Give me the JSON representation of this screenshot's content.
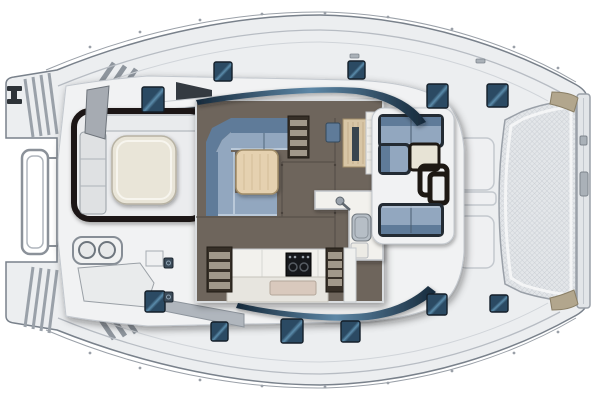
{
  "title": "Catamaran yacht deck and saloon floor plan, top view, bow to the right",
  "image_type": "boat-floor-plan-illustration",
  "orientation": {
    "bow": "right",
    "stern": "left"
  },
  "palette": {
    "bg": "#ffffff",
    "hull": "#eceef0",
    "hull_stroke": "#79818b",
    "deck": "#f1f2f3",
    "deck_line": "#c3c8ce",
    "inner_line": "#b7bcc3",
    "floor": "#6e655c",
    "floor_seam": "#58514a",
    "sofa_back": "#5f7b99",
    "sofa_seat": "#92a7bf",
    "sofa_hi": "#bac9d9",
    "sofa_frame": "#232b33",
    "table_wood": "#e5d1b0",
    "table_wood_edge": "#a08c67",
    "table_cream": "#e9e5d8",
    "table_cream_edge": "#b7b2a3",
    "counter": "#f2f1ed",
    "counter_front": "#e7e5df",
    "counter_edge": "#c0c4c9",
    "sink_tray": "#d9c9bd",
    "sink_steel": "#b6bec6",
    "cooktop": "#16181c",
    "steps_dark": "#362f27",
    "tread": "#a1988a",
    "nav_desk": "#d8c6a6",
    "nav_panel": "#39454e",
    "bench_grey": "#dfe1e3",
    "seat_grey": "#a6abb2",
    "frame_dark": "#1d1813",
    "hatch": "#2b4a63",
    "hatch_hi": "#5b8cab",
    "hatch_stroke": "#141f2a",
    "swoosh": "#16293a",
    "swoosh_hi": "#5d87a6",
    "mesh": "#e3e6e9",
    "mesh_line": "#c6cbd1",
    "beam": "#e2e5e8",
    "metal": "#9aa0a8",
    "tan_fitting": "#b2a68d",
    "tan_edge": "#8a7f66",
    "wedge_grey": "#b0b6bd",
    "entry_dark": "#343a41"
  },
  "hatches": [
    {
      "x": 214,
      "y": 62,
      "w": 18,
      "h": 19
    },
    {
      "x": 348,
      "y": 61,
      "w": 17,
      "h": 18
    },
    {
      "x": 142,
      "y": 87,
      "w": 22,
      "h": 25
    },
    {
      "x": 427,
      "y": 84,
      "w": 21,
      "h": 24
    },
    {
      "x": 487,
      "y": 84,
      "w": 21,
      "h": 23
    },
    {
      "x": 145,
      "y": 291,
      "w": 20,
      "h": 21
    },
    {
      "x": 211,
      "y": 322,
      "w": 17,
      "h": 19
    },
    {
      "x": 281,
      "y": 319,
      "w": 22,
      "h": 24
    },
    {
      "x": 341,
      "y": 321,
      "w": 19,
      "h": 21
    },
    {
      "x": 427,
      "y": 294,
      "w": 20,
      "h": 21
    },
    {
      "x": 490,
      "y": 295,
      "w": 18,
      "h": 17
    }
  ],
  "deck_fittings": [
    {
      "x": 164,
      "y": 258,
      "w": 9,
      "h": 10
    },
    {
      "x": 164,
      "y": 292,
      "w": 9,
      "h": 10
    }
  ],
  "rail_cleats": [
    {
      "x": 350,
      "y": 54,
      "w": 9,
      "h": 4
    },
    {
      "x": 476,
      "y": 59,
      "w": 9,
      "h": 4
    }
  ],
  "stanchions": {
    "top": [
      [
        90,
        47
      ],
      [
        140,
        32
      ],
      [
        200,
        20
      ],
      [
        262,
        14
      ],
      [
        325,
        13
      ],
      [
        388,
        17
      ],
      [
        452,
        29
      ],
      [
        514,
        47
      ],
      [
        558,
        68
      ]
    ],
    "bottom": [
      [
        90,
        353
      ],
      [
        140,
        368
      ],
      [
        200,
        380
      ],
      [
        262,
        386
      ],
      [
        325,
        387
      ],
      [
        388,
        383
      ],
      [
        452,
        371
      ],
      [
        514,
        353
      ],
      [
        558,
        332
      ]
    ]
  },
  "elements": [
    "port-transom-steps",
    "starboard-transom-steps",
    "stern-boarding-rail",
    "stern-cleat",
    "aft-cockpit",
    "cockpit-dining-table",
    "cockpit-bench",
    "helm-seat",
    "wet-bar-grill-two-burners",
    "saloon",
    "saloon-l-sofa",
    "saloon-coffee-table",
    "starboard-companionway-steps",
    "port-companionway-steps",
    "galley-companionway-steps",
    "nav-station-desk",
    "nav-station-seat",
    "galley-counter",
    "cooktop",
    "galley-sink-island",
    "sink-faucet",
    "forward-cockpit",
    "forward-sofa-upper",
    "forward-sofa-lower",
    "forward-cocktail-table",
    "foredeck-lockers",
    "bow-trampoline",
    "forward-crossbeam",
    "bow-fittings",
    "deck-hatches",
    "windshield-band",
    "lifeline-rails"
  ]
}
